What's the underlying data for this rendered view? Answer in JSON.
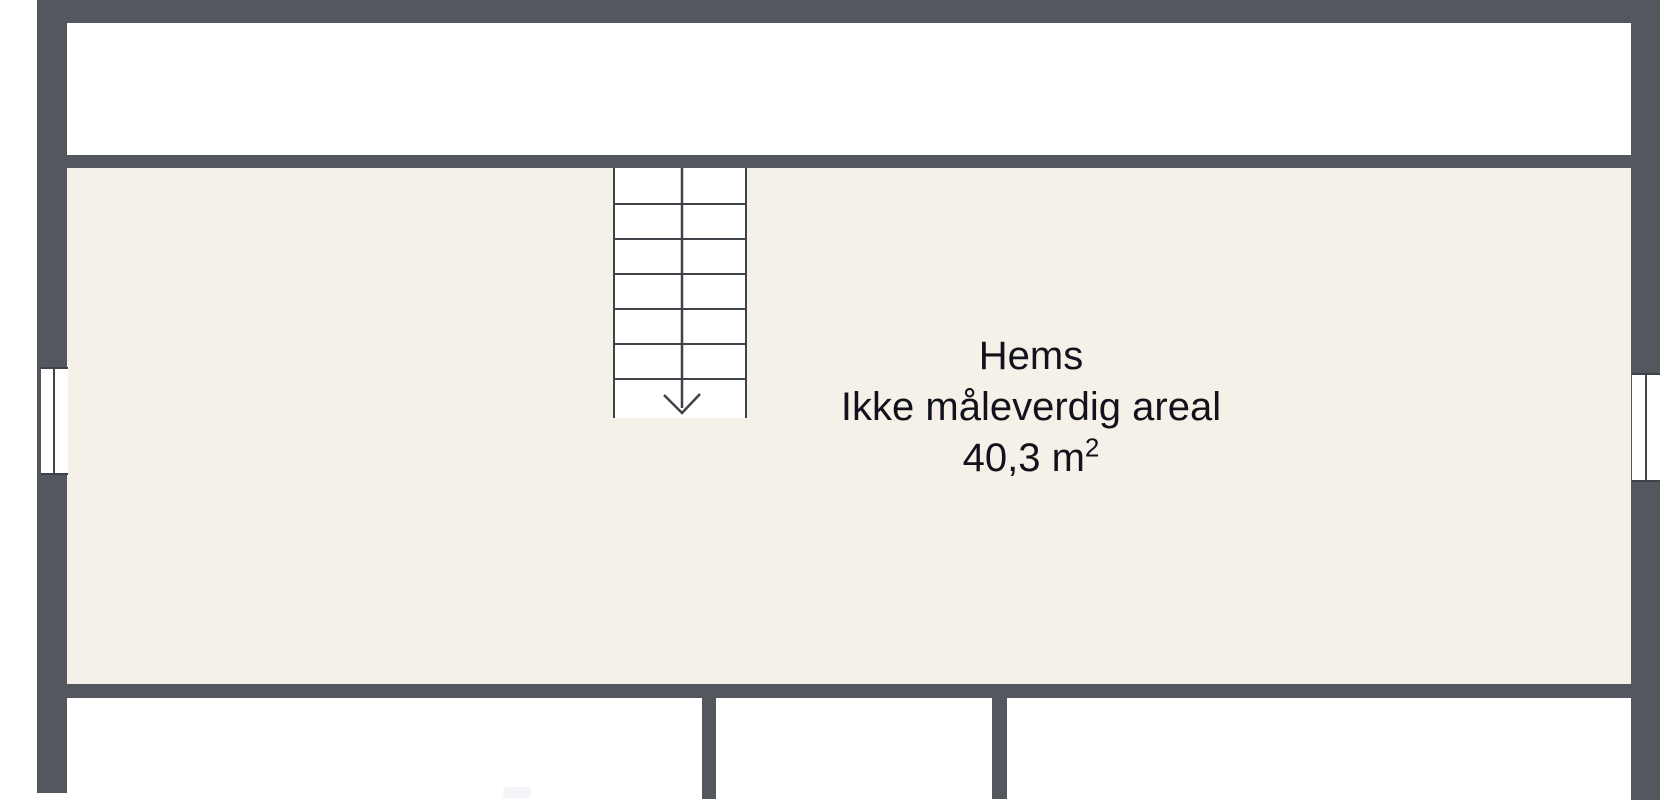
{
  "room": {
    "label": "Hems",
    "note": "Ikke måleverdig areal",
    "area": "40,3 m",
    "area_sup": "2"
  },
  "stairs": {
    "tread_count": 6,
    "tread_spacing_px": 35,
    "direction": "down"
  },
  "colors": {
    "wall": "#54575d",
    "room_fill": "#f6f1e8",
    "background": "#ffffff",
    "line": "#3f4248",
    "text": "#12121c"
  }
}
